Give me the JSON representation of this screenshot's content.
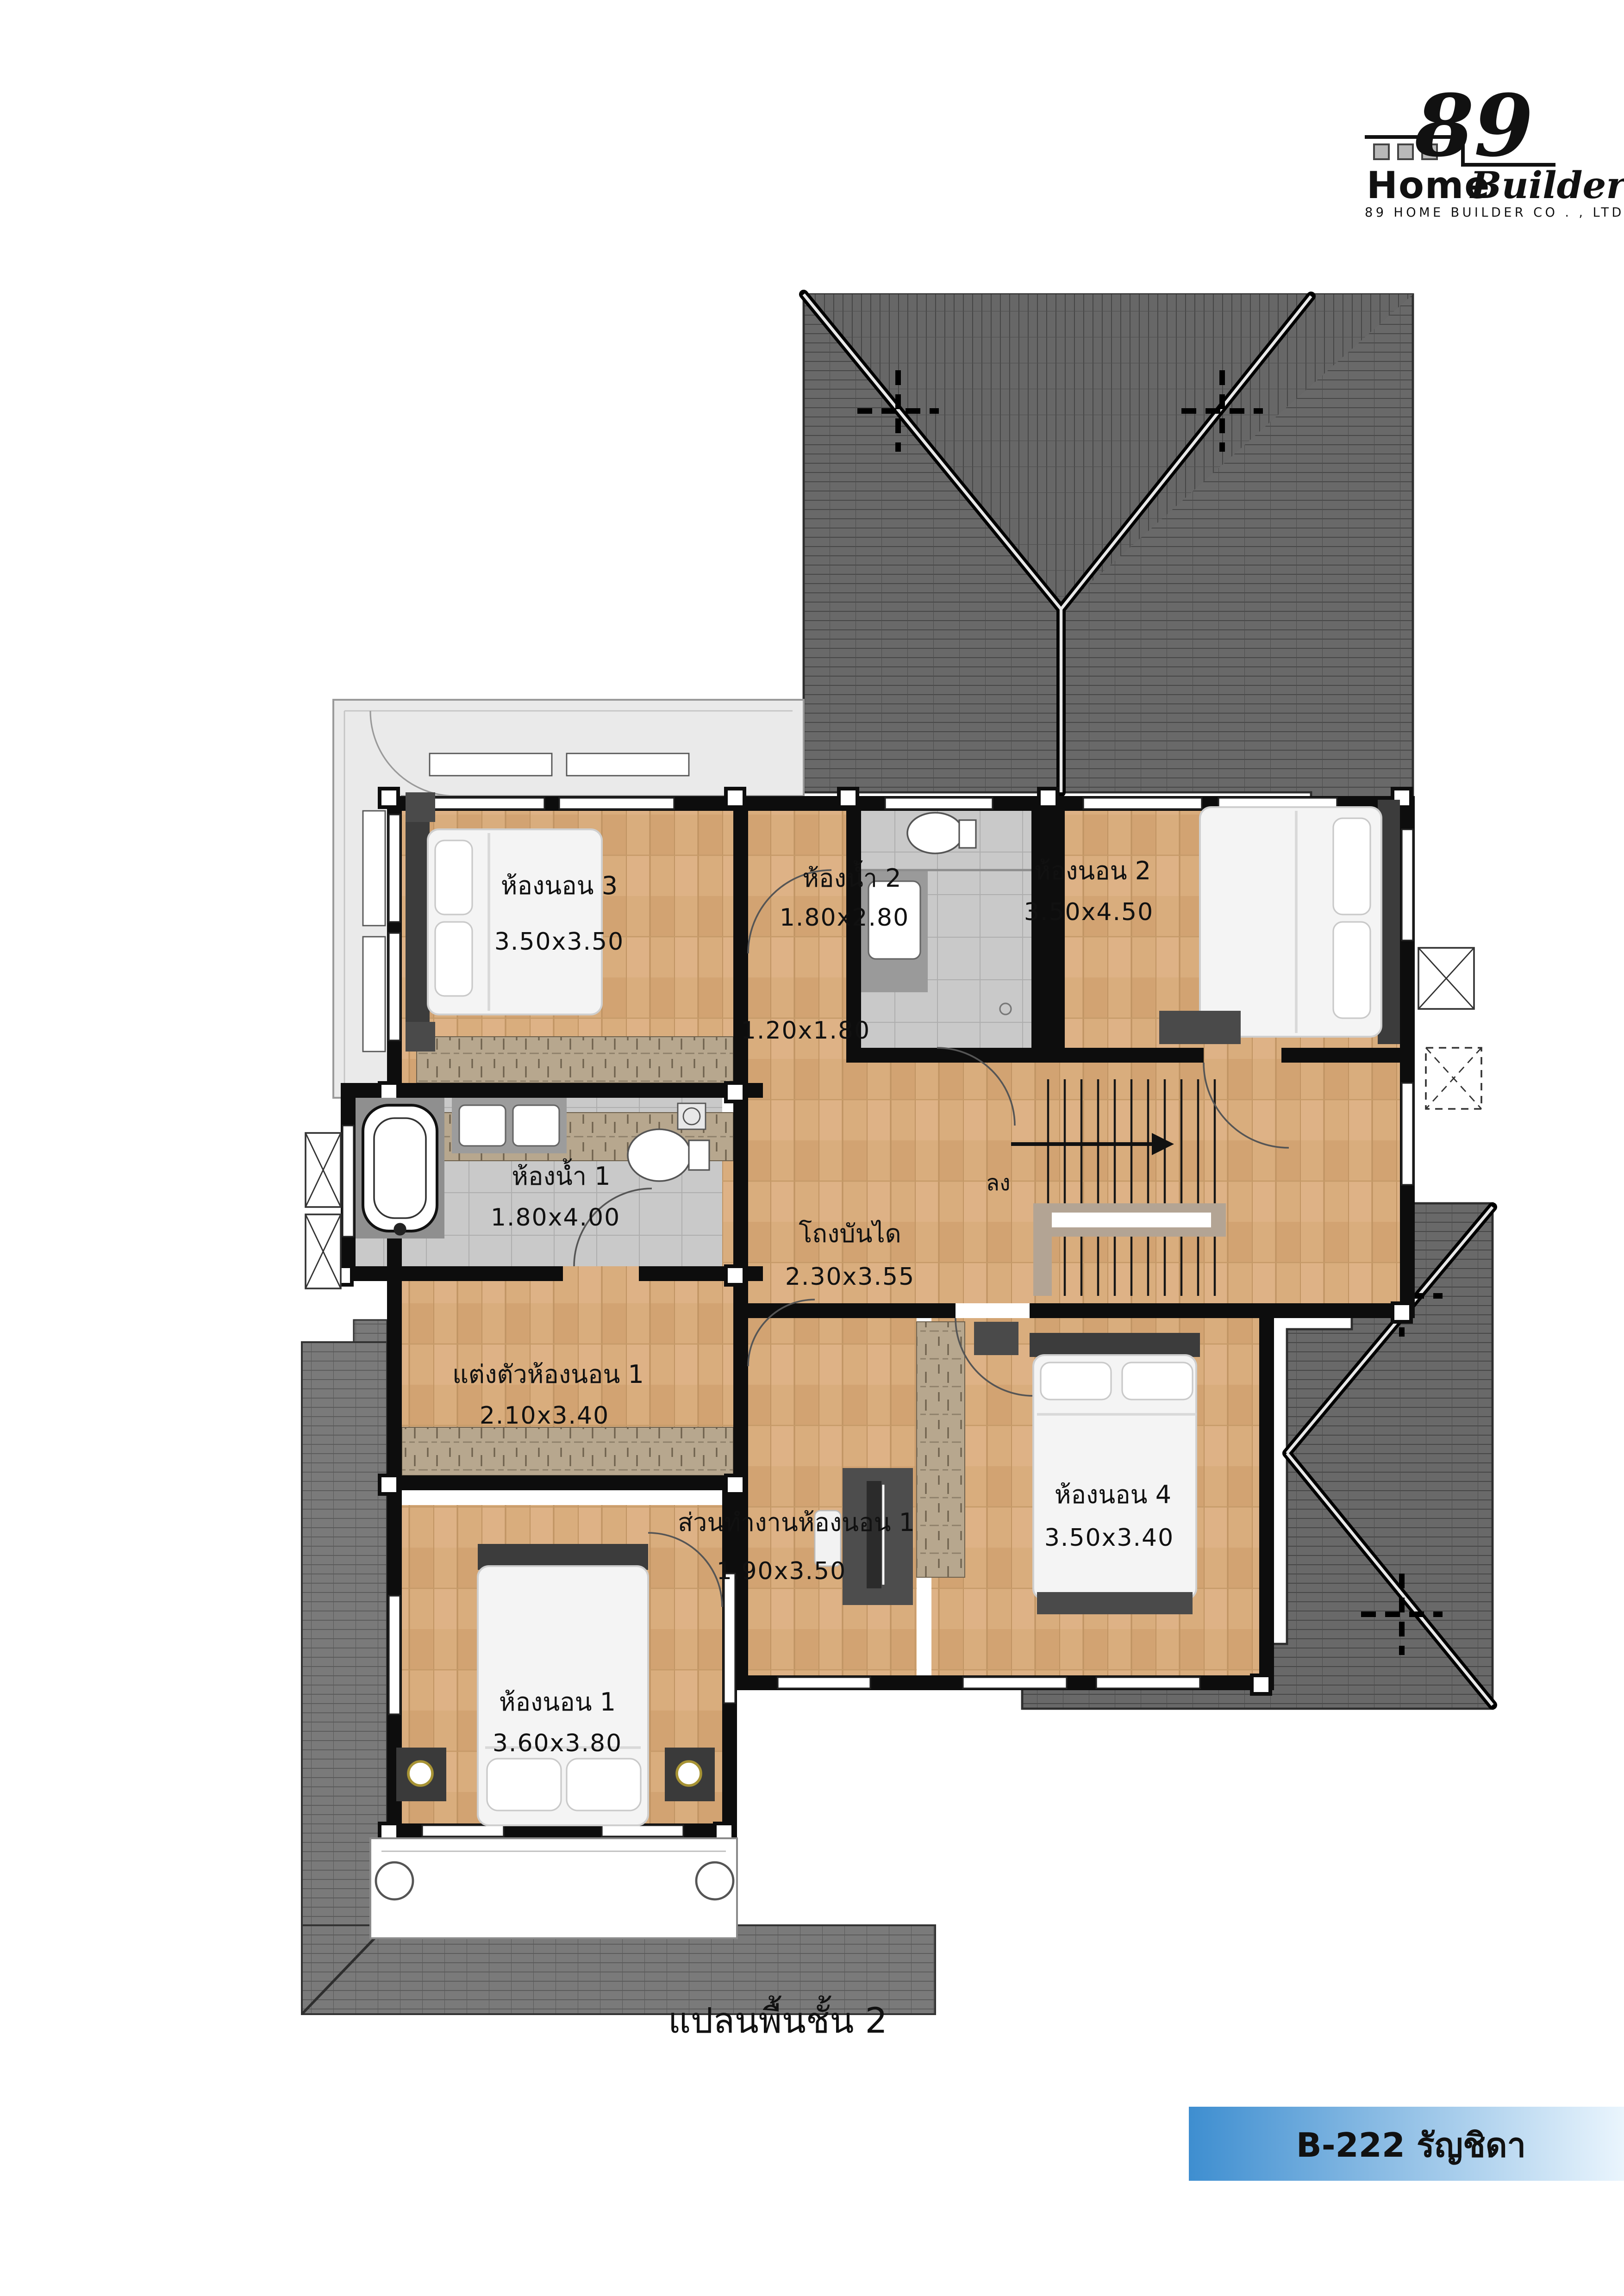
{
  "logo": {
    "number": "89",
    "home": "Home",
    "builder": "Builder",
    "company": "89  HOME  BUILDER  CO . , LTD .",
    "blue": "#1e96e8",
    "red": "#c41414"
  },
  "rooms": {
    "bedroom3": {
      "name": "ห้องนอน 3",
      "size": "3.50x3.50"
    },
    "bathroom2": {
      "name": "ห้องน้ำ 2",
      "size": "1.80x2.80"
    },
    "bedroom2": {
      "name": "ห้องนอน 2",
      "size": "3.50x4.50"
    },
    "corridor": {
      "size": "1.20x1.80"
    },
    "stairhall": {
      "name": "โถงบันได",
      "size": "2.30x3.55"
    },
    "stairs": {
      "down": "ลง"
    },
    "bathroom1": {
      "name": "ห้องน้ำ 1",
      "size": "1.80x4.00"
    },
    "dressing": {
      "name": "แต่งตัวห้องนอน 1",
      "size": "2.10x3.40"
    },
    "work": {
      "name": "ส่วนทำงานห้องนอน 1",
      "size": "1.90x3.50"
    },
    "bedroom4": {
      "name": "ห้องนอน 4",
      "size": "3.50x3.40"
    },
    "bedroom1": {
      "name": "ห้องนอน 1",
      "size": "3.60x3.80"
    }
  },
  "caption": "แปลนพื้นชั้น 2",
  "banner": {
    "text": "B-222 รัญชิดา",
    "gradient_from": "#3e8ed0",
    "gradient_to": "#eaf5fd"
  },
  "colors": {
    "wood": "#d9ad7d",
    "roof": "#696969",
    "roof_light": "#767676",
    "tile": "#c9c9c9",
    "wall": "#0d0d0d",
    "terrace": "#eaeaea",
    "wardrobe": "#b7a78e"
  }
}
